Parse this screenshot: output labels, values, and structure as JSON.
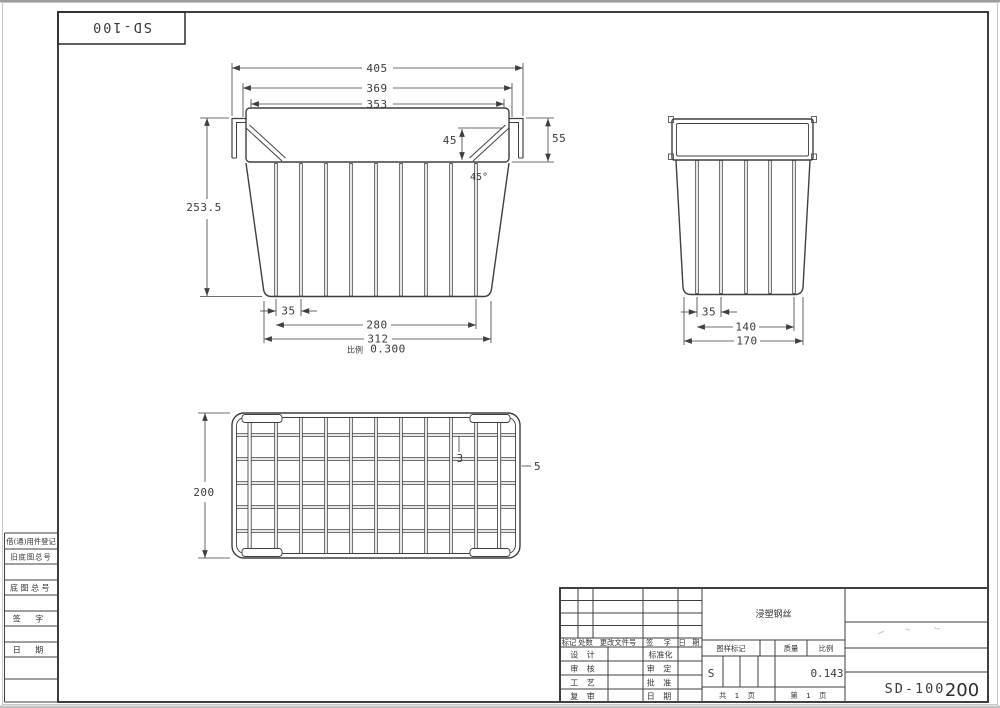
{
  "colors": {
    "line": "#3f3f3f",
    "frame": "#2a2a2a",
    "text": "#3a3a3a"
  },
  "corner_block": {
    "drawing_no": "SD-100"
  },
  "front_view": {
    "dim_overall_width": "405",
    "dim_rim_width": "369",
    "dim_opening_width": "353",
    "dim_brace_height": "45",
    "dim_hook_height": "55",
    "dim_brace_angle": "45°",
    "dim_total_height": "253.5",
    "dim_wire_pitch": "35",
    "dim_wire_span": "280",
    "dim_bottom_width": "312",
    "scale_label": "比例",
    "scale_value": "0.300"
  },
  "side_view": {
    "dim_wire_pitch": "35",
    "dim_wire_span": "140",
    "dim_bottom_width": "170"
  },
  "plan_view": {
    "dim_depth": "200",
    "dim_grid_wire_dia": "3",
    "dim_rim_wire_dia": "5"
  },
  "left_margin": {
    "rows": [
      "借(通)用件登记",
      "旧底图总号",
      "",
      "底图总号",
      "",
      "签  字",
      "",
      "日  期",
      "",
      ""
    ]
  },
  "title_block": {
    "revision_headers": [
      "标记",
      "处数",
      "更改文件号",
      "签 字",
      "日 期"
    ],
    "sign_rows": [
      [
        "设 计",
        "标准化"
      ],
      [
        "审 核",
        "审 定"
      ],
      [
        "工 艺",
        "批 准"
      ],
      [
        "复 审",
        "日 期"
      ]
    ],
    "material": "浸塑钢丝",
    "stamp_label": "图样标记",
    "weight_label": "质量",
    "scale_label": "比例",
    "stage_mark": "S",
    "scale_value": "0.143",
    "sheet_total": "共 1 页",
    "sheet_number": "第 1 页",
    "drawing_no": "SD-100",
    "model_no": "200"
  }
}
